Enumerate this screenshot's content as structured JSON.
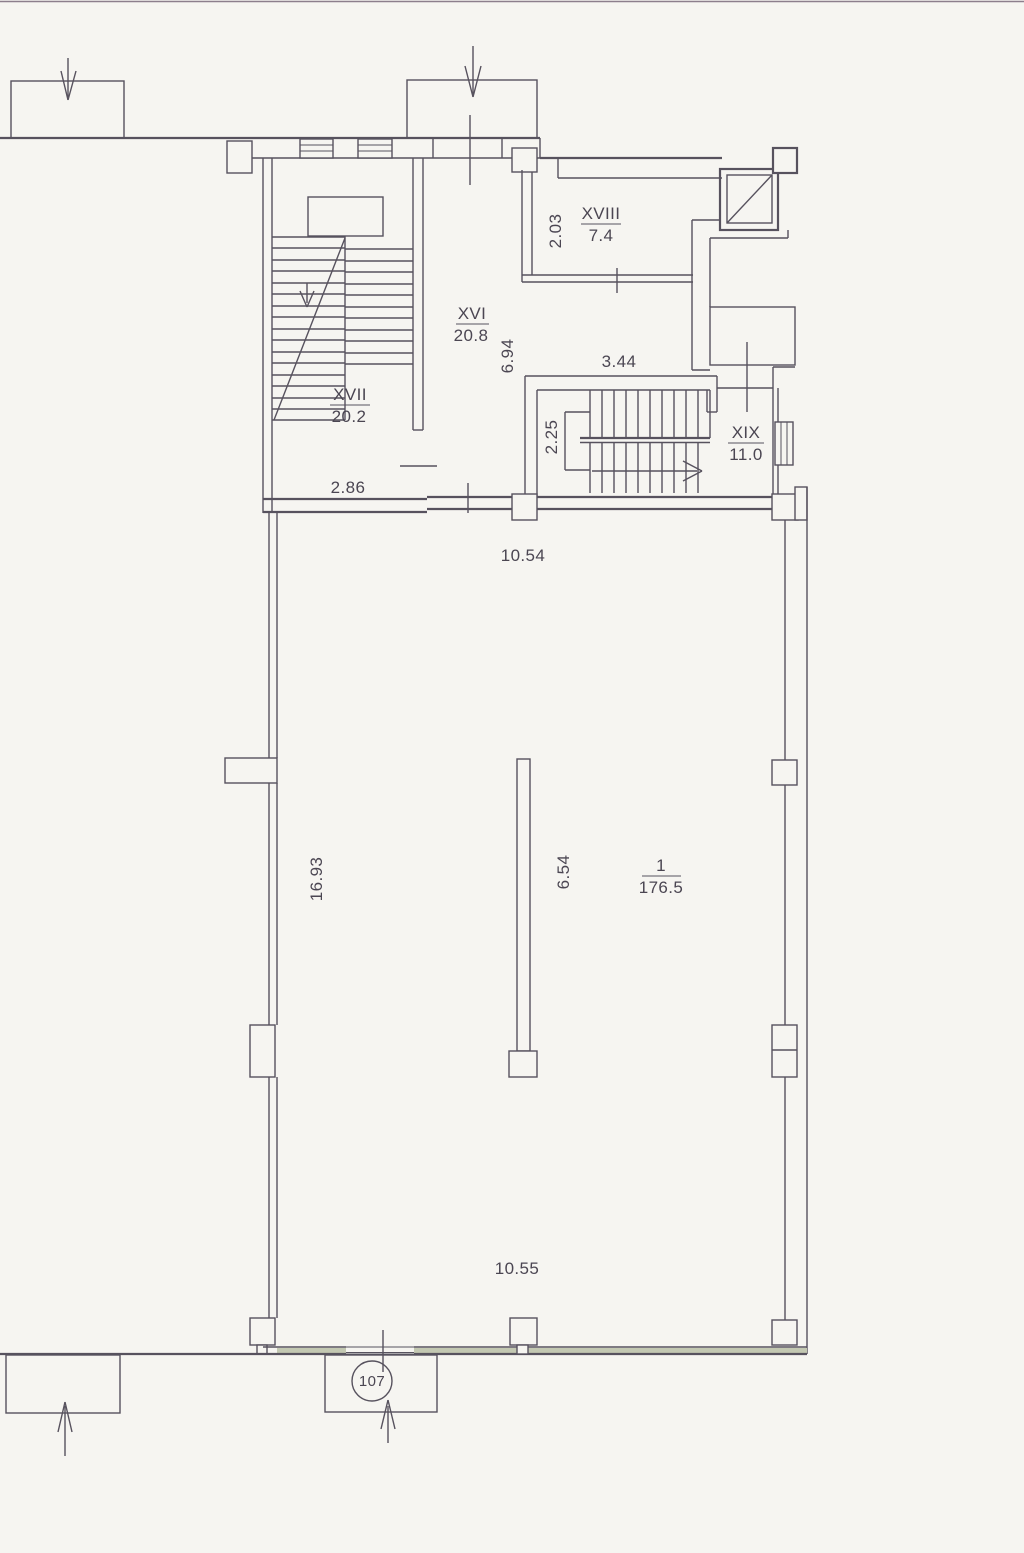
{
  "document": {
    "kind": "scanned architectural floor plan",
    "main_room_marker": "107"
  },
  "colors": {
    "paper": "#f6f5f1",
    "line": "#57525e",
    "text": "#4b4652",
    "wall_band": "#c3c8b2"
  },
  "labels": {
    "rooms": [
      {
        "numeral": "XVI",
        "area": "20.8"
      },
      {
        "numeral": "XVII",
        "area": "20.2"
      },
      {
        "numeral": "XVIII",
        "area": "7.4"
      },
      {
        "numeral": "XIX",
        "area": "11.0"
      },
      {
        "numeral": "1",
        "area": "176.5"
      }
    ],
    "dims": {
      "w203": "2.03",
      "w694": "6.94",
      "w344": "3.44",
      "w225": "2.25",
      "w286": "2.86",
      "w1054": "10.54",
      "w1693": "16.93",
      "w654": "6.54",
      "w1055": "10.55"
    },
    "marker107": "107"
  }
}
